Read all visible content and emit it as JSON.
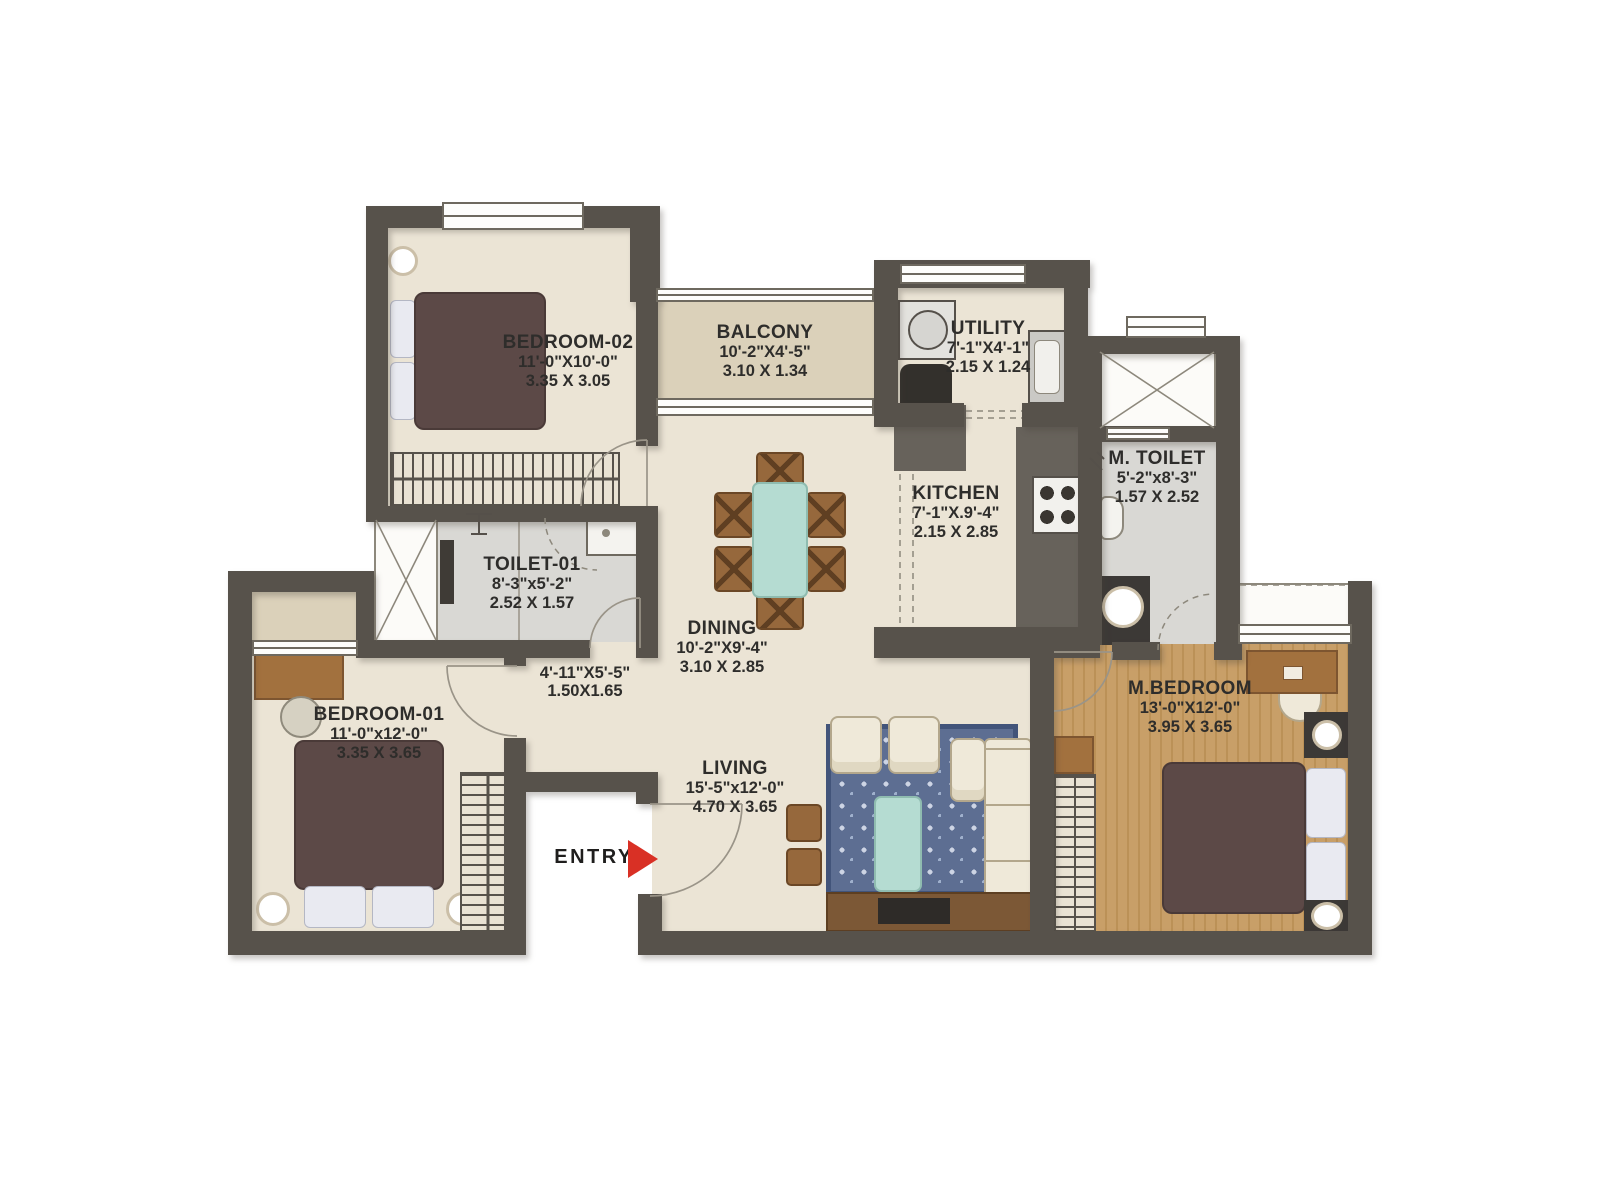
{
  "plan_type": "apartment-floor-plan",
  "palette": {
    "wall": "#57524b",
    "floor_cream": "#ebe4d5",
    "floor_balcony": "#dbd1ba",
    "floor_toilet": "#d9d8d4",
    "floor_wood": "#c89f68",
    "table_teal": "#b5dcd2",
    "rug_blue": "#5d6e92",
    "bed_blanket": "#5c4947",
    "furniture_brown": "#96683c",
    "entry_arrow_red": "#d93025"
  },
  "rooms": {
    "bedroom02": {
      "name": "BEDROOM-02",
      "dim_ft": "11'-0\"X10'-0\"",
      "dim_m": "3.35 X 3.05"
    },
    "balcony": {
      "name": "BALCONY",
      "dim_ft": "10'-2\"X4'-5\"",
      "dim_m": "3.10 X 1.34"
    },
    "utility": {
      "name": "UTILITY",
      "dim_ft": "7'-1\"X4'-1\"",
      "dim_m": "2.15 X 1.24"
    },
    "kitchen": {
      "name": "KITCHEN",
      "dim_ft": "7'-1\"X.9'-4\"",
      "dim_m": "2.15 X 2.85"
    },
    "mtoilet": {
      "name": "M. TOILET",
      "dim_ft": "5'-2\"x8'-3\"",
      "dim_m": "1.57 X 2.52"
    },
    "toilet01": {
      "name": "TOILET-01",
      "dim_ft": "8'-3\"x5'-2\"",
      "dim_m": "2.52 X 1.57"
    },
    "passage": {
      "dim_ft": "4'-11\"X5'-5\"",
      "dim_m": "1.50X1.65"
    },
    "dining": {
      "name": "DINING",
      "dim_ft": "10'-2\"X9'-4\"",
      "dim_m": "3.10 X 2.85"
    },
    "living": {
      "name": "LIVING",
      "dim_ft": "15'-5\"x12'-0\"",
      "dim_m": "4.70 X 3.65"
    },
    "bedroom01": {
      "name": "BEDROOM-01",
      "dim_ft": "11'-0\"x12'-0\"",
      "dim_m": "3.35 X 3.65"
    },
    "mbedroom": {
      "name": "M.BEDROOM",
      "dim_ft": "13'-0\"X12'-0\"",
      "dim_m": "3.95 X 3.65"
    }
  },
  "entry": {
    "label": "ENTRY"
  }
}
